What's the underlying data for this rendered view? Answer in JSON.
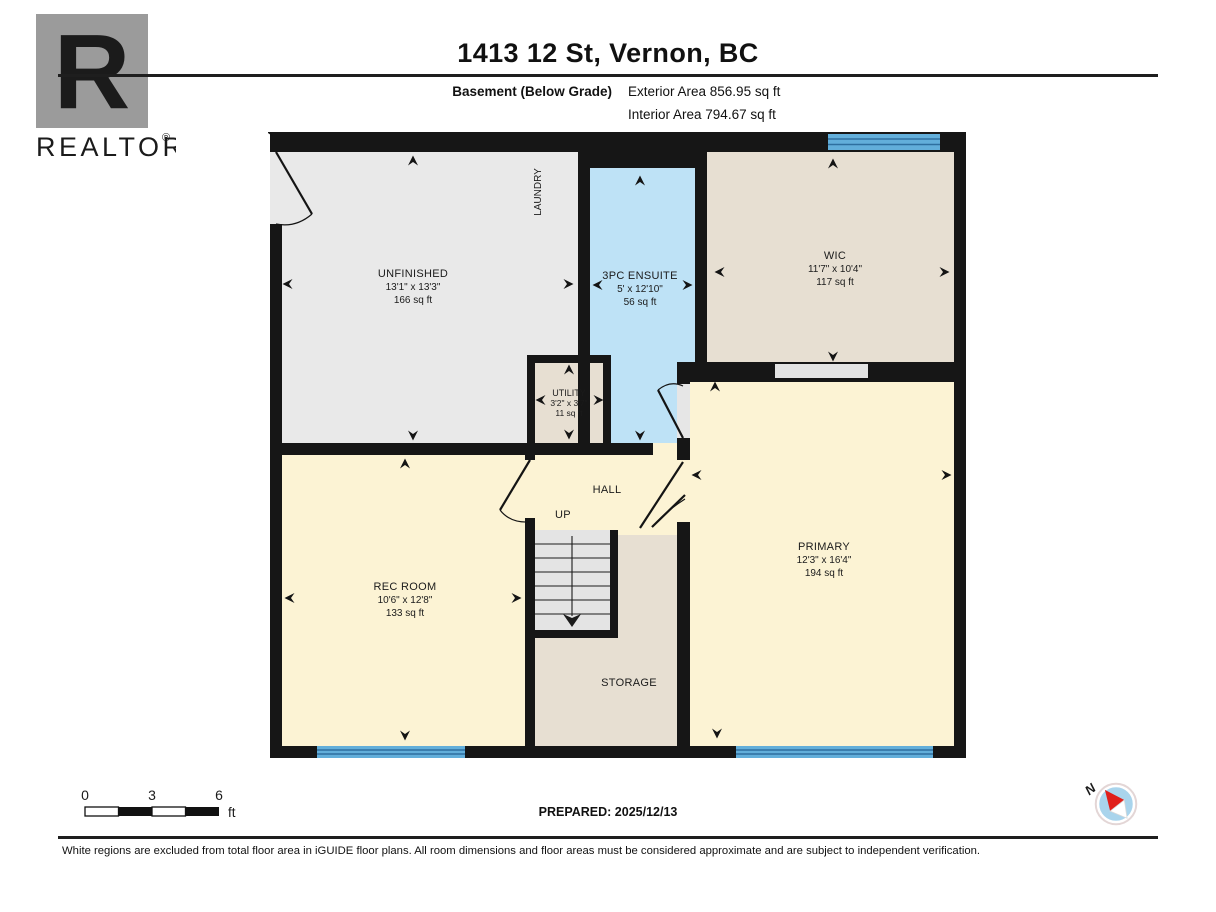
{
  "header": {
    "title": "1413 12 St, Vernon, BC",
    "floor_label": "Basement (Below Grade)",
    "exterior_area": "Exterior Area 856.95 sq ft",
    "interior_area": "Interior Area 794.67 sq ft",
    "logo_letter": "R",
    "logo_text": "REALTOR",
    "logo_reg": "®"
  },
  "rooms": {
    "unfinished": {
      "name": "UNFINISHED",
      "dims": "13'1\" x 13'3\"",
      "area": "166 sq ft"
    },
    "laundry": {
      "name": "LAUNDRY"
    },
    "ensuite": {
      "name": "3PC ENSUITE",
      "dims": "5' x 12'10\"",
      "area": "56 sq ft"
    },
    "wic": {
      "name": "WIC",
      "dims": "11'7\" x 10'4\"",
      "area": "117 sq ft"
    },
    "utility": {
      "name": "UTILITY",
      "dims": "3'2\" x 3'7\"",
      "area": "11 sq ft"
    },
    "hall": {
      "name": "HALL"
    },
    "up": {
      "label": "UP"
    },
    "rec_room": {
      "name": "REC ROOM",
      "dims": "10'6\" x 12'8\"",
      "area": "133 sq ft"
    },
    "storage": {
      "name": "STORAGE"
    },
    "primary": {
      "name": "PRIMARY",
      "dims": "12'3\" x 16'4\"",
      "area": "194 sq ft"
    }
  },
  "footer": {
    "scale": {
      "t0": "0",
      "t3": "3",
      "t6": "6",
      "unit": "ft"
    },
    "prepared": "PREPARED: 2025/12/13",
    "compass_n": "N",
    "disclaimer": "White regions are excluded from total floor area in iGUIDE floor plans. All room dimensions and floor areas must be considered approximate and are subject to independent verification."
  },
  "colors": {
    "wall": "#161616",
    "room_gray": "#e9e9e9",
    "room_blue": "#bee2f6",
    "room_tan": "#e7dfd2",
    "room_cream": "#fcf3d4",
    "stairs_gray": "#e4e4e4",
    "window_blue": "#62aeda",
    "logo_gray": "#9b9b9b",
    "compass_blue": "#a9d4ec",
    "compass_red": "#e01f1a"
  }
}
